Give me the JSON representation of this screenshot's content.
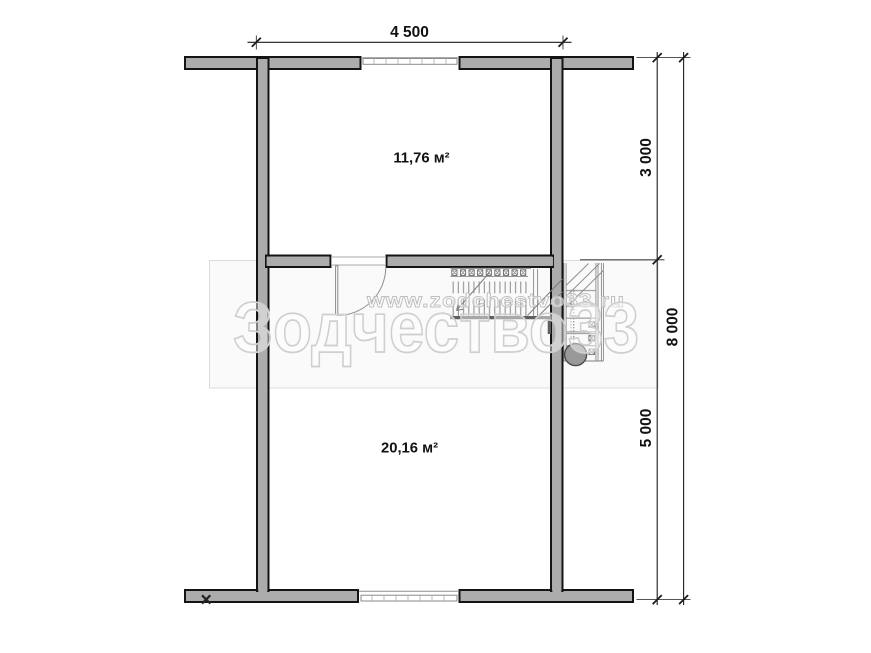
{
  "plan": {
    "type": "floor-plan",
    "dimensions": {
      "width_top": "4 500",
      "right_upper": "3 000",
      "right_lower": "5 000",
      "right_total": "8 000"
    },
    "rooms": [
      {
        "name": "upper-room",
        "area_label": "11,76 м²"
      },
      {
        "name": "lower-room",
        "area_label": "20,16 м²"
      }
    ],
    "watermark": {
      "brand": "Зодчество33",
      "url": "www.zodchestvo33.ru"
    },
    "icons": {
      "corner_mark": "×",
      "stair_newel": "filled-circle"
    },
    "colors": {
      "wall_fill": "#acacac",
      "wall_outline": "#141414",
      "dimension_text": "#111111",
      "stair_lines": "#7d7d7d",
      "watermark_text": "#cfcfcf",
      "background": "#ffffff"
    }
  }
}
